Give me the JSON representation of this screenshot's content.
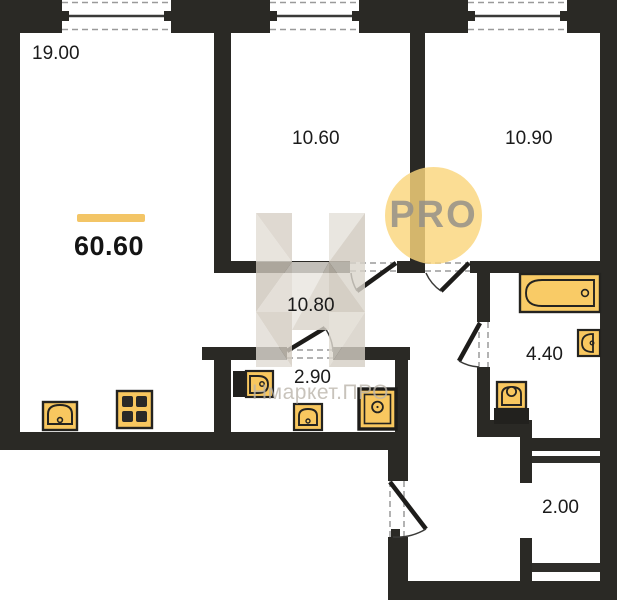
{
  "plan": {
    "total_area": "60.60",
    "rooms": [
      {
        "name": "living-kitchen",
        "area": "19.00"
      },
      {
        "name": "bedroom-1",
        "area": "10.60"
      },
      {
        "name": "bedroom-2",
        "area": "10.90"
      },
      {
        "name": "hallway",
        "area": "10.80"
      },
      {
        "name": "wc",
        "area": "2.90"
      },
      {
        "name": "bathroom",
        "area": "4.40"
      },
      {
        "name": "balcony",
        "area": "2.00"
      }
    ],
    "fixtures": [
      "kitchen-sink-icon",
      "stove-icon",
      "wall-sink-icon",
      "basin-icon",
      "washing-machine-icon",
      "bathtub-icon",
      "bathroom-sink-icon",
      "toilet-icon"
    ],
    "colors": {
      "wall": "#2a2925",
      "fixture_yellow": "#f8c75f",
      "accent_bar": "#f3c566",
      "watermark_circle": "#fad67c"
    }
  },
  "watermark": {
    "pro_label": "PRO",
    "brand_label": "Нмаркет.ПРО"
  }
}
